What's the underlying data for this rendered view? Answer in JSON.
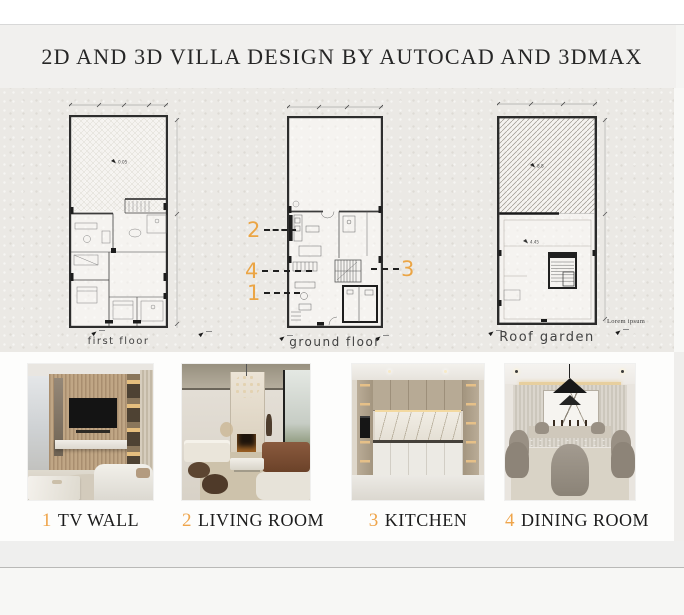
{
  "accent_color": "#eba545",
  "header": {
    "title": "2D AND 3D VILLA DESIGN BY AUTOCAD AND 3DMAX"
  },
  "plans": {
    "first_floor": {
      "label": "first floor",
      "level_mark": "0.05"
    },
    "ground_floor": {
      "label": "ground floor",
      "markers": {
        "m1": "1",
        "m2": "2",
        "m3": "3",
        "m4": "4"
      }
    },
    "roof_garden": {
      "label": "Roof garden",
      "level_mark": "8.8",
      "level_mark_2": "4.45",
      "note": "Lorem ipsum"
    }
  },
  "gallery": {
    "items": [
      {
        "number": "1",
        "label": "TV WALL"
      },
      {
        "number": "2",
        "label": "LIVING ROOM"
      },
      {
        "number": "3",
        "label": "KITCHEN"
      },
      {
        "number": "4",
        "label": "DINING ROOM"
      }
    ]
  }
}
